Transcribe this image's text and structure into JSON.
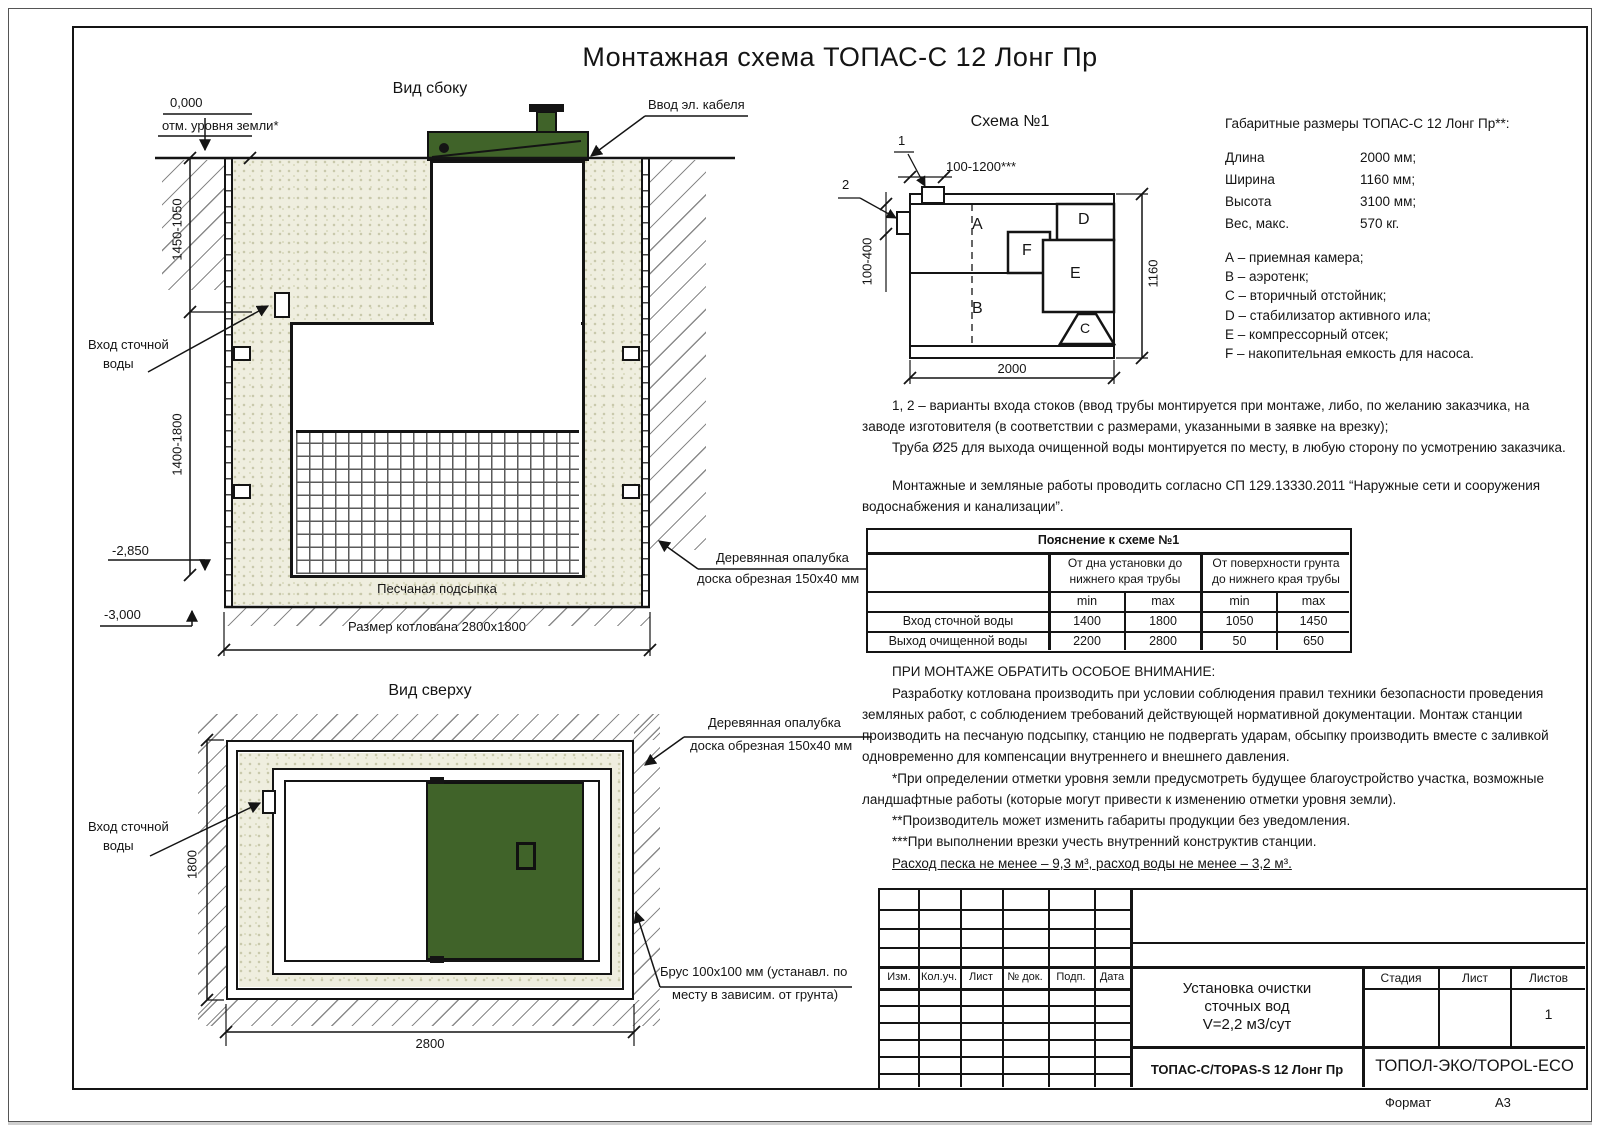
{
  "page": {
    "title": "Монтажная схема ТОПАС-С 12 Лонг Пр",
    "format_label": "Формат",
    "format_value": "А3"
  },
  "side_view": {
    "title": "Вид сбоку",
    "mark_zero": "0,000",
    "mark_zero_label": "отм. уровня земли*",
    "cable_label": "Ввод эл. кабеля",
    "dim_upper": "1450-1050",
    "dim_lower": "1400-1800",
    "inlet_line1": "Вход сточной",
    "inlet_line2": "воды",
    "mark_minus2850": "-2,850",
    "mark_minus3000": "-3,000",
    "sand_label": "Песчаная подсыпка",
    "pit_dim_label": "Размер котлована 2800х1800",
    "formwork_line1": "Деревянная опалубка",
    "formwork_line2": "доска обрезная 150х40 мм"
  },
  "top_view": {
    "title": "Вид сверху",
    "inlet_line1": "Вход сточной",
    "inlet_line2": "воды",
    "dim_side": "1800",
    "dim_bottom": "2800",
    "formwork_line1": "Деревянная опалубка",
    "formwork_line2": "доска обрезная 150х40 мм",
    "beam_line1": "Брус 100х100 мм (устанавл. по",
    "beam_line2": "месту в зависим. от грунта)"
  },
  "schema": {
    "title": "Схема №1",
    "callout1": "1",
    "callout2": "2",
    "dim_inlet_range": "100-1200***",
    "dim_left_range": "100-400",
    "dim_length": "2000",
    "dim_width": "1160",
    "ch_a": "A",
    "ch_b": "B",
    "ch_c": "C",
    "ch_d": "D",
    "ch_e": "E",
    "ch_f": "F"
  },
  "specs": {
    "title": "Габаритные размеры ТОПАС-С 12 Лонг Пр**:",
    "rows": [
      {
        "label": "Длина",
        "value": "2000 мм;"
      },
      {
        "label": "Ширина",
        "value": "1160 мм;"
      },
      {
        "label": "Высота",
        "value": "3100 мм;"
      },
      {
        "label": "Вес, макс.",
        "value": "570 кг."
      }
    ],
    "legend": [
      "А – приемная камера;",
      "В – аэротенк;",
      "С – вторичный отстойник;",
      "D – стабилизатор активного ила;",
      "E – компрессорный отсек;",
      "F – накопительная емкость для насоса."
    ]
  },
  "notes": {
    "variants_lines": [
      "1, 2 – варианты входа  стоков (ввод трубы монтируется при монтаже, либо, по желанию заказчика, на",
      "заводе изготовителя (в соответствии с размерами, указанными в заявке на врезку);",
      "Труба Ø25 для выхода очищенной воды монтируется по месту, в любую сторону по усмотрению заказчика."
    ],
    "works_lines": [
      "Монтажные и земляные работы проводить согласно СП 129.13330.2011 “Наружные сети и сооружения",
      "водоснабжения и канализации”."
    ]
  },
  "pipe_table": {
    "title": "Пояснение к схеме №1",
    "group1_line1": "От дна установки до",
    "group1_line2": "нижнего края трубы",
    "group2_line1": "От поверхности грунта",
    "group2_line2": "до нижнего края трубы",
    "min_label": "min",
    "max_label": "max",
    "rows": [
      {
        "label": "Вход сточной воды",
        "v1": "1400",
        "v2": "1800",
        "v3": "1050",
        "v4": "1450"
      },
      {
        "label": "Выход очищенной воды",
        "v1": "2200",
        "v2": "2800",
        "v3": "50",
        "v4": "650"
      }
    ]
  },
  "attention": {
    "heading": "ПРИ МОНТАЖЕ ОБРАТИТЬ ОСОБОЕ ВНИМАНИЕ:",
    "body_lines": [
      "Разработку котлована производить при условии соблюдения правил техники безопасности проведения",
      "земляных работ, с соблюдением требований действующей нормативной документации. Монтаж станции",
      "производить на песчаную подсыпку, станцию не подвергать ударам, обсыпку производить вместе с заливкой",
      "одновременно для компенсации внутреннего и внешнего давления."
    ],
    "footnote_lines": [
      "*При определении отметки уровня земли предусмотреть будущее благоустройство участка, возможные",
      "ландшафтные работы (которые могут привести к изменению отметки уровня земли).",
      "**Производитель может изменить габариты продукции без уведомления.",
      "***При выполнении врезки учесть внутренний конструктив станции."
    ],
    "consumption": "Расход песка не менее – 9,3 м³, расход воды не менее – 3,2 м³."
  },
  "stamp": {
    "rev_cols": [
      "Изм.",
      "Кол.уч.",
      "Лист",
      "№ док.",
      "Подп.",
      "Дата"
    ],
    "name_line1": "Установка очистки",
    "name_line2": "сточных вод",
    "name_line3": "V=2,2 м3/сут",
    "stage_label": "Стадия",
    "sheet_label": "Лист",
    "sheets_label": "Листов",
    "sheets_value": "1",
    "model": "ТОПАС-С/TOPAS-S 12 Лонг Пр",
    "company": "ТОПОЛ-ЭКО/TOPOL-ECO"
  },
  "colors": {
    "green": "#406329",
    "sand": "#efeedf",
    "line": "#141414"
  }
}
